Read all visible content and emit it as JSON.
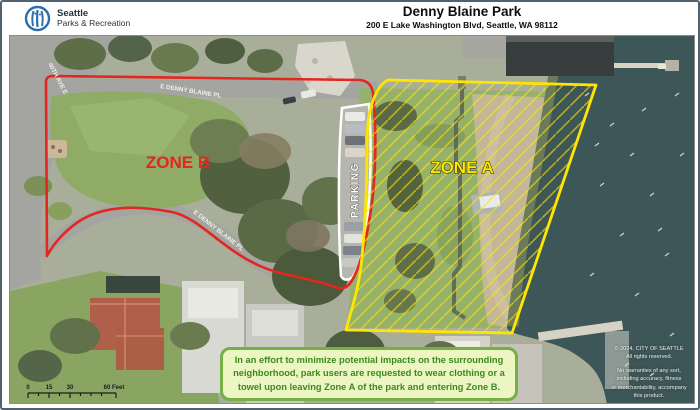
{
  "header": {
    "logo": {
      "line1": "Seattle",
      "line2": "Parks & Recreation",
      "icon": "seattle-parks-logo"
    },
    "title": "Denny Blaine Park",
    "address": "200 E Lake Washington Blvd, Seattle, WA 98112"
  },
  "map": {
    "zone_a_label": "ZONE A",
    "zone_b_label": "ZONE B",
    "parking_label": "PARKING",
    "streets": {
      "denny_top": "E DENNY BLAINE PL",
      "denny_mid": "E DENNY BLAINE PL",
      "ave_40th": "40TH AVE E"
    },
    "notice": "In an effort to minimize potential impacts on the surrounding neighborhood, park users are requested to wear clothing or a towel upon leaving Zone A of the park and entering Zone B.",
    "credits": {
      "l1": "© 2024, CITY OF SEATTLE",
      "l2": "All rights reserved.",
      "l3": "No warranties of any sort,",
      "l4": "including accuracy, fitness",
      "l5": "or merchantability, accompany",
      "l6": "this product.",
      "l7": "Map date: May 06, 2024"
    },
    "scalebar": {
      "t0": "0",
      "t1": "15",
      "t2": "30",
      "t3": "60 Feet"
    }
  },
  "colors": {
    "zone_a": "#ffe600",
    "zone_b": "#e3261f",
    "note_bg": "#edf5c3",
    "note_border": "#74b043",
    "note_text": "#3c8a1d",
    "logo_blue": "#2e6cae",
    "water": "#3d5658"
  }
}
